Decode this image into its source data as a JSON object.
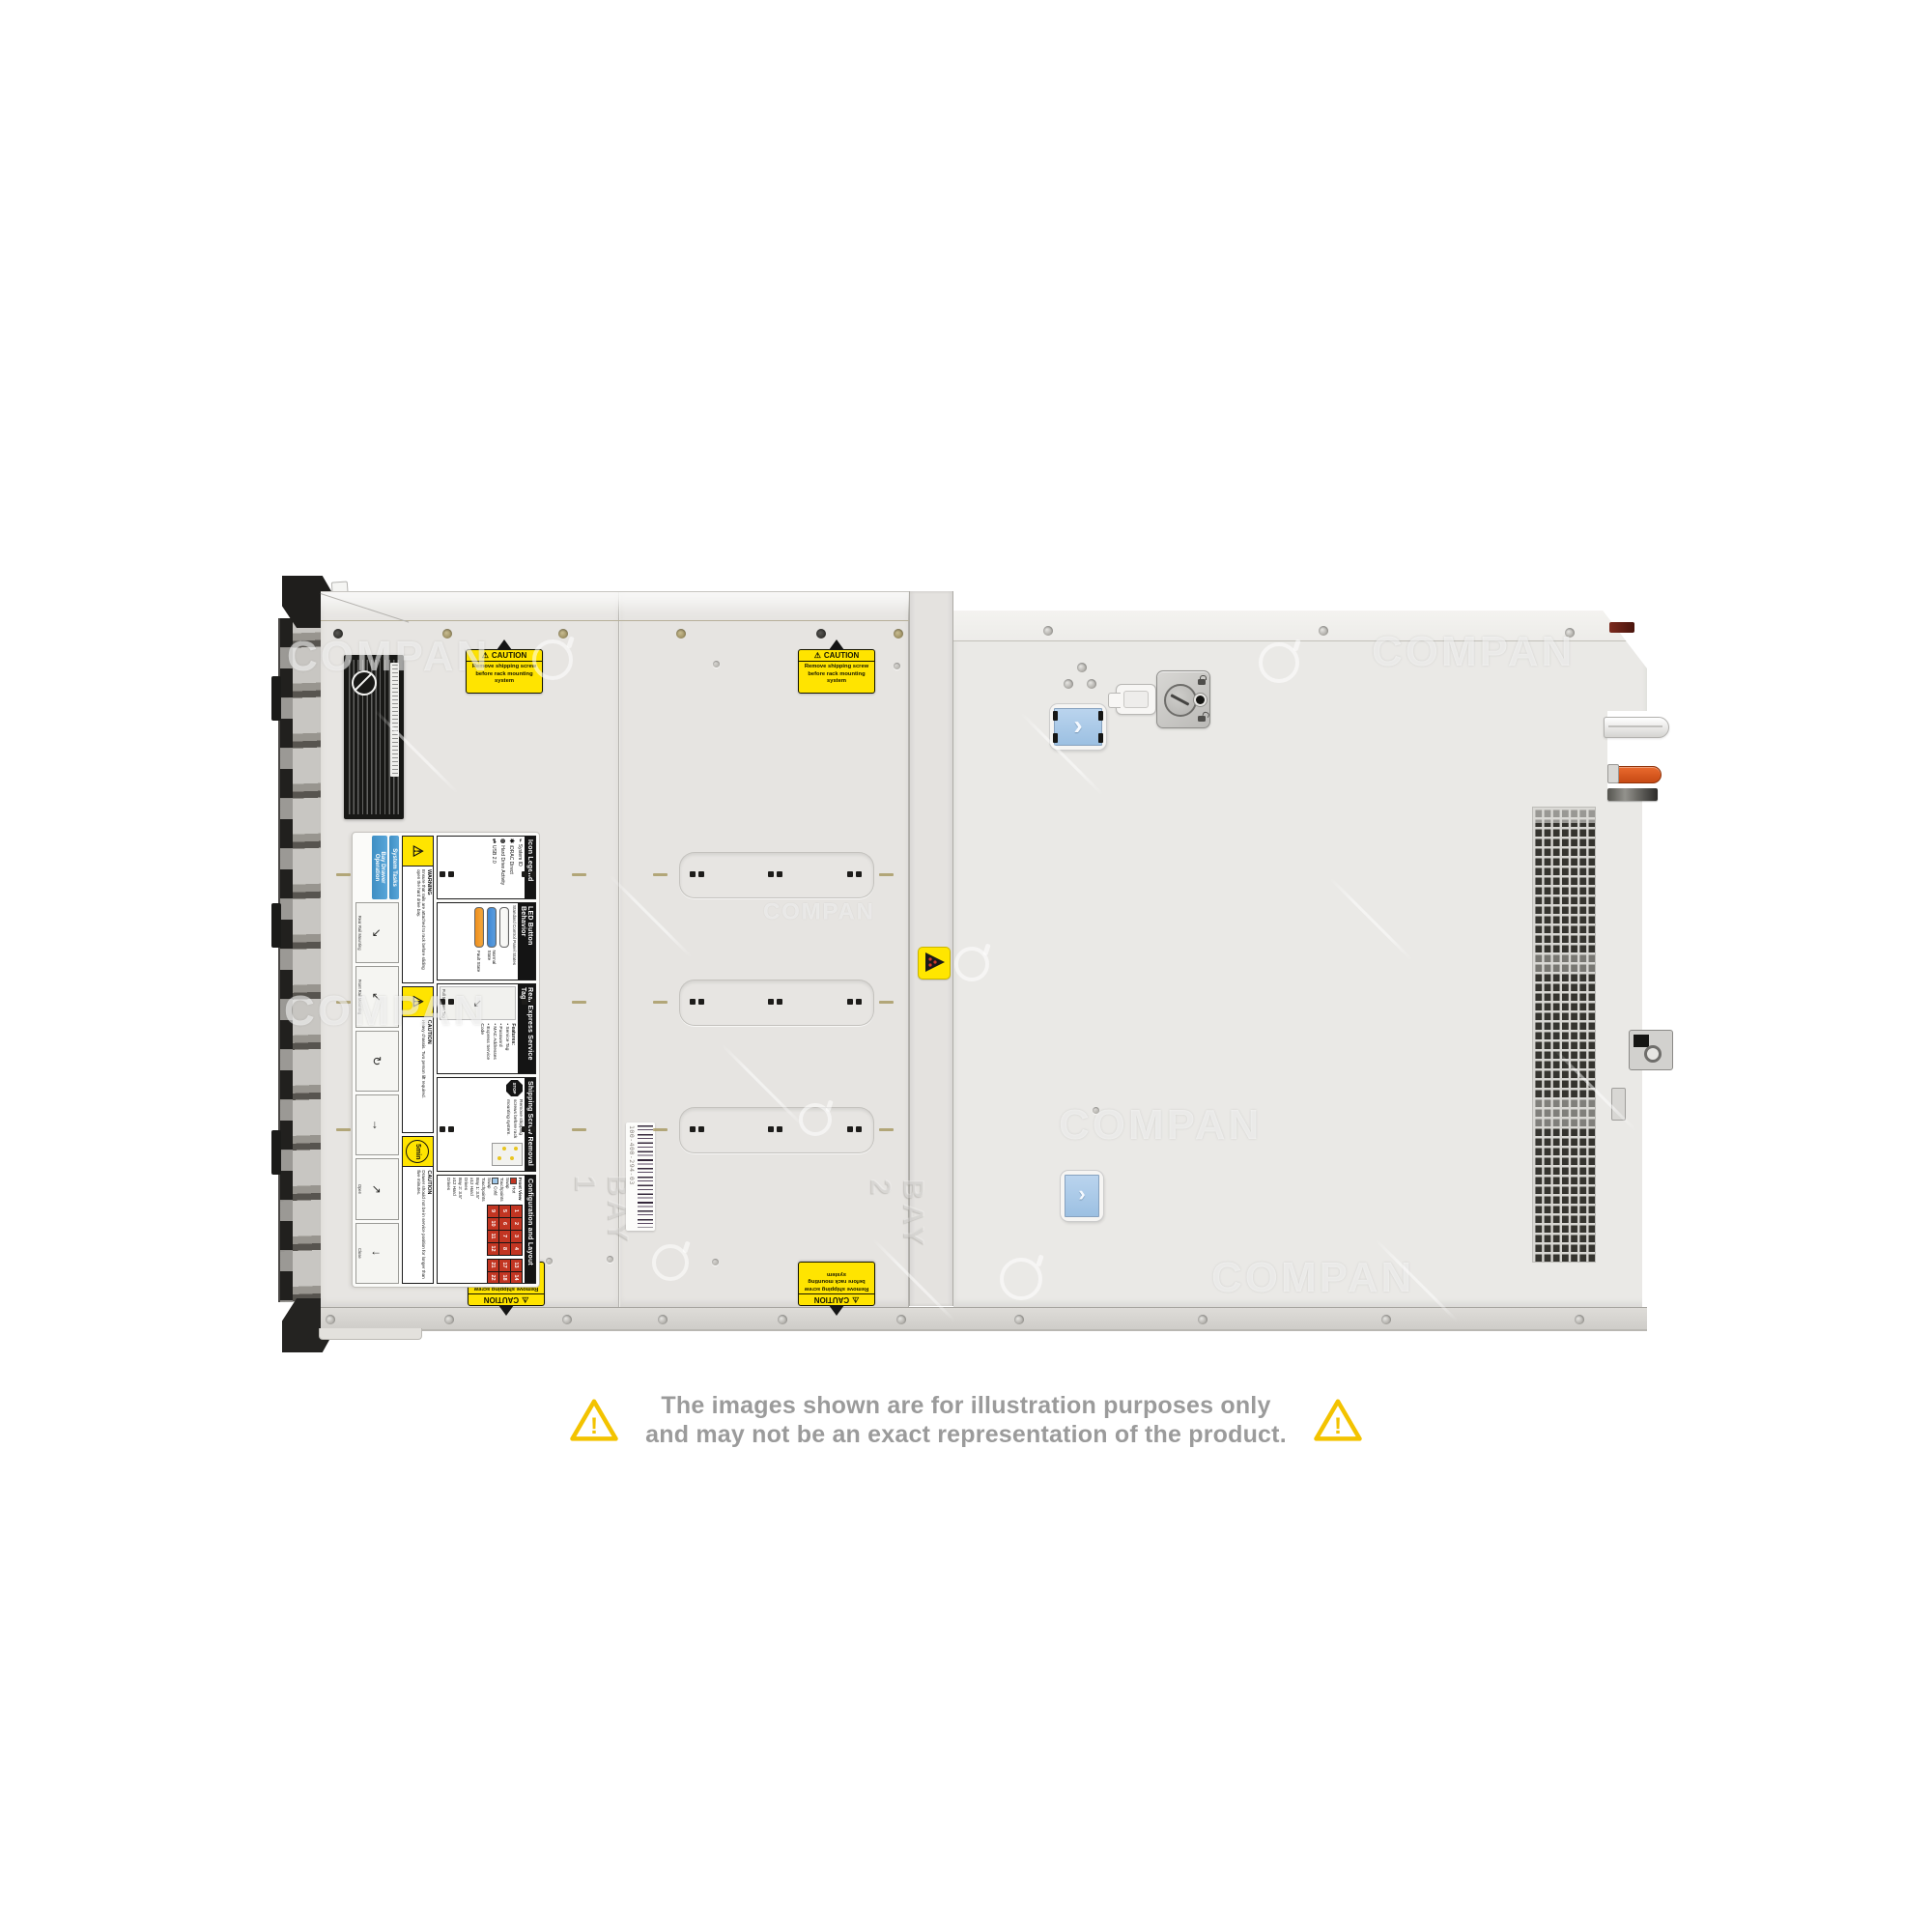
{
  "watermark": {
    "text": "COMPAN"
  },
  "server": {
    "caution_label": {
      "symbol": "⚠",
      "title": "CAUTION",
      "line1": "Remove shipping screw",
      "line2": "before rack mounting system"
    },
    "barcode_label": {
      "text": "100-400-294-03"
    },
    "embossing": {
      "bay1": "BAY 1",
      "bay2": "BAY 2"
    },
    "latch": {
      "chevron": "›"
    },
    "service_label": {
      "chips": [
        "System Tasks",
        "Bay Drawer Operation"
      ],
      "icon_legend": {
        "title": "Icon Legend",
        "items": [
          "System ID",
          "iDRAC Direct",
          "Hard Drive Activity",
          "USB 2.0"
        ]
      },
      "led": {
        "title": "LED Button Behavior",
        "subtitle": "Standard Control Panel States",
        "normal": "Normal State",
        "fault": "Fault State"
      },
      "rear_tag": {
        "title": "Rear Express Service Tag",
        "features_heading": "Features:",
        "features": [
          "Service Tag",
          "Password",
          "MAC Addresses",
          "Express Service Code"
        ],
        "note": "Pull to open Tag"
      },
      "shipping": {
        "title": "Shipping Screw Removal",
        "stop": "STOP",
        "text": "Remove shipping screws before rack mounting system."
      },
      "config": {
        "title": "Configuration and Layout",
        "front_view": "Front View",
        "hot": "Hot Swap Touchpoints",
        "cold": "Cold Swap Touchpoints",
        "bay1": "Bay 1: 3.5\" x12 Hard Drives",
        "bay2": "Bay 2: 3.5\" x12 Hard Drives",
        "grid1": [
          "1",
          "2",
          "3",
          "4",
          "5",
          "6",
          "7",
          "8",
          "9",
          "10",
          "11",
          "12"
        ],
        "grid2": [
          "13",
          "14",
          "15",
          "16",
          "17",
          "18",
          "19",
          "20",
          "21",
          "22",
          "23",
          "24"
        ]
      },
      "warnings": [
        {
          "symbol": "⚠",
          "title": "WARNING",
          "text": "Ensure that rails are attached to rack before sliding open the hard drive bay."
        },
        {
          "symbol": "⚠",
          "title": "CAUTION",
          "text": "Heavy chassis. Two person lift required."
        },
        {
          "symbol": "⚠",
          "title": "CAUTION",
          "badge": "5min",
          "text": "Drawer should not be in service position for longer than five minutes."
        }
      ],
      "steps": [
        "Rear Rail Mounting",
        "Front Rail Mounting",
        "Open",
        "Close"
      ]
    }
  },
  "disclaimer": {
    "mark": "!",
    "line1": "The images shown are for illustration purposes only",
    "line2": "and may not be an exact representation of the product."
  }
}
